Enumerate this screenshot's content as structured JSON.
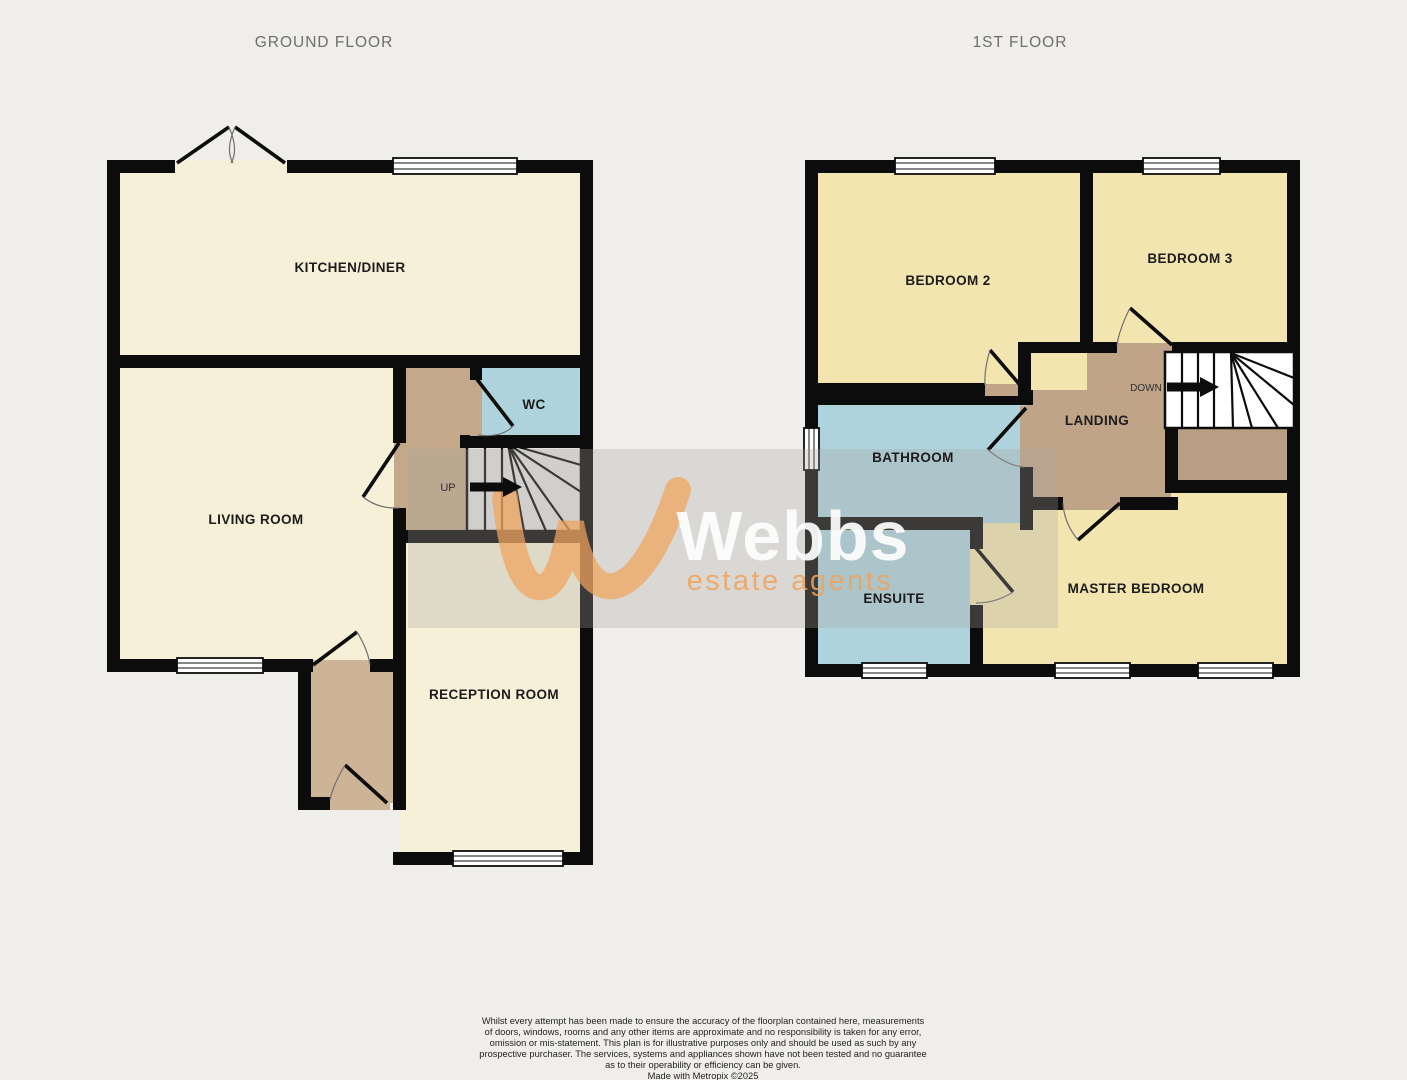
{
  "titles": {
    "ground": "GROUND FLOOR",
    "first": "1ST FLOOR"
  },
  "ground_floor": {
    "kitchen": "KITCHEN/DINER",
    "living_room": "LIVING ROOM",
    "wc": "WC",
    "reception": "RECEPTION ROOM",
    "stair_direction": "UP"
  },
  "first_floor": {
    "bedroom2": "BEDROOM 2",
    "bedroom3": "BEDROOM 3",
    "bathroom": "BATHROOM",
    "landing": "LANDING",
    "ensuite": "ENSUITE",
    "master_bedroom": "MASTER BEDROOM",
    "stair_direction": "DOWN"
  },
  "watermark": {
    "brand": "Webbs",
    "tagline": "estate agents"
  },
  "disclaimer": {
    "lines": [
      "Whilst every attempt has been made to ensure the accuracy of the floorplan contained here, measurements",
      "of doors, windows, rooms and any other items are approximate and no responsibility is taken for any error,",
      "omission or mis-statement. This plan is for illustrative purposes only and should be used as such by any",
      "prospective purchaser. The services, systems and appliances shown have not been tested and no guarantee",
      "as to their operability or efficiency can be given.",
      "Made with Metropix ©2025"
    ]
  },
  "colors": {
    "bg": "#f0eeeb",
    "wall": "#0c0c0c",
    "cream": "#f6f0d8",
    "bedroomYellow": "#f3e5b0",
    "blue": "#aed3dc",
    "hallTan": "#c3a98a",
    "porchTan": "#cdb496",
    "landingTan": "#bfa487",
    "cupboardTan": "#b89e82",
    "stairGray": "#e2e1e0",
    "stairWhite": "#ffffff",
    "labelInk": "#1c1c1c",
    "titleGray": "#6e6e6e",
    "wmOrange": "#f0a35c",
    "wmWhite": "#ffffff",
    "wmBandGray": "#a9a6a3"
  }
}
